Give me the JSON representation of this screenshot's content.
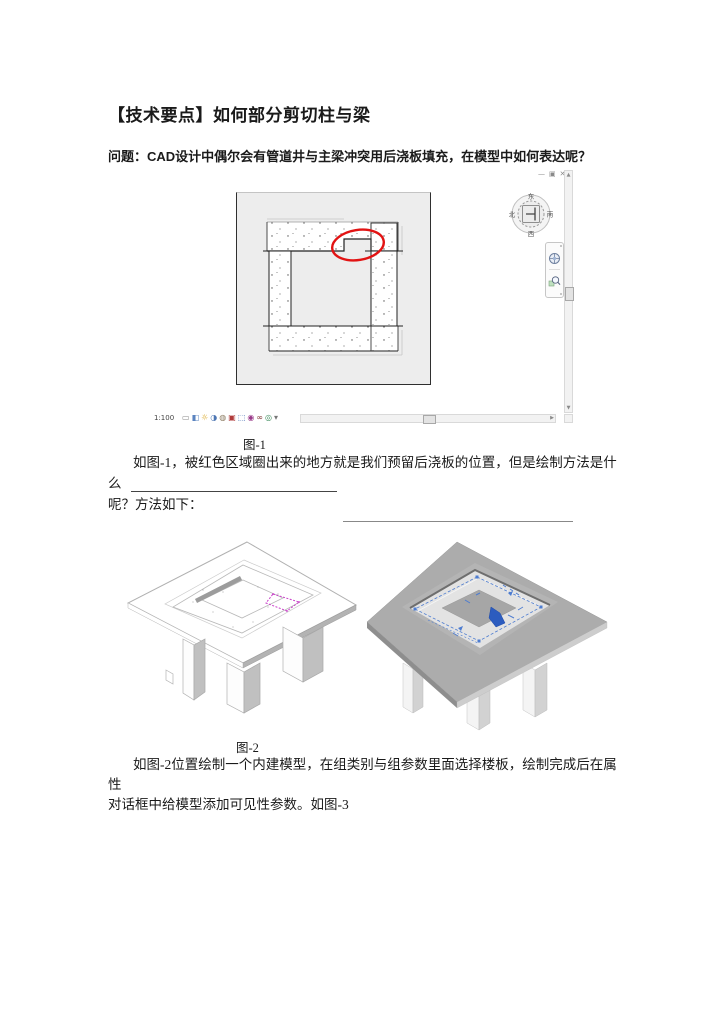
{
  "article": {
    "title": "【技术要点】如何部分剪切柱与梁",
    "question": "问题：CAD设计中偶尔会有管道井与主梁冲突用后浇板填充，在模型中如何表达呢？",
    "fig1_caption": "图-1",
    "para1_line1": "如图-1，被红色区域圈出来的地方就是我们预留后浇板的位置，但是绘制方法是什么",
    "para1_line2": "呢？方法如下：",
    "fig2_caption": "图-2",
    "para2_line1": "如图-2位置绘制一个内建模型，在组类别与组参数里面选择楼板，绘制完成后在属性",
    "para2_line2": "对话框中给模型添加可见性参数。如图-3"
  },
  "revit": {
    "window_controls": [
      {
        "name": "minimize-icon",
        "glyph": "—"
      },
      {
        "name": "restore-icon",
        "glyph": "▣"
      },
      {
        "name": "close-icon",
        "glyph": "✕"
      }
    ],
    "compass": {
      "north": "北",
      "east": "东",
      "south": "南",
      "west": "西"
    },
    "view_bar": {
      "scale": "1:100",
      "icons": [
        {
          "name": "detail-level-icon",
          "glyph": "▭",
          "color": "#8a8a8a"
        },
        {
          "name": "visual-style-icon",
          "glyph": "◧",
          "color": "#5b84c0"
        },
        {
          "name": "sun-path-icon",
          "glyph": "☼",
          "color": "#d9a520"
        },
        {
          "name": "shadows-icon",
          "glyph": "◑",
          "color": "#4d76b3"
        },
        {
          "name": "rendering-icon",
          "glyph": "◍",
          "color": "#8a7a60"
        },
        {
          "name": "crop-view-icon",
          "glyph": "▣",
          "color": "#b03a3a"
        },
        {
          "name": "crop-region-icon",
          "glyph": "⬚",
          "color": "#3a66b0"
        },
        {
          "name": "lock-3d-icon",
          "glyph": "◉",
          "color": "#9a3a8a"
        },
        {
          "name": "temp-hide-icon",
          "glyph": "∞",
          "color": "#7a3030"
        },
        {
          "name": "reveal-hidden-icon",
          "glyph": "◎",
          "color": "#3a8a5a"
        },
        {
          "name": "more-icon",
          "glyph": "▾",
          "color": "#777777"
        }
      ]
    },
    "colors": {
      "highlight_ellipse": "#e21313",
      "canvas_bg": "#ededed",
      "annotation_blue": "#4d7cd0",
      "sketch_magenta": "#c93fc9",
      "slab_gray": "#acacac"
    }
  }
}
